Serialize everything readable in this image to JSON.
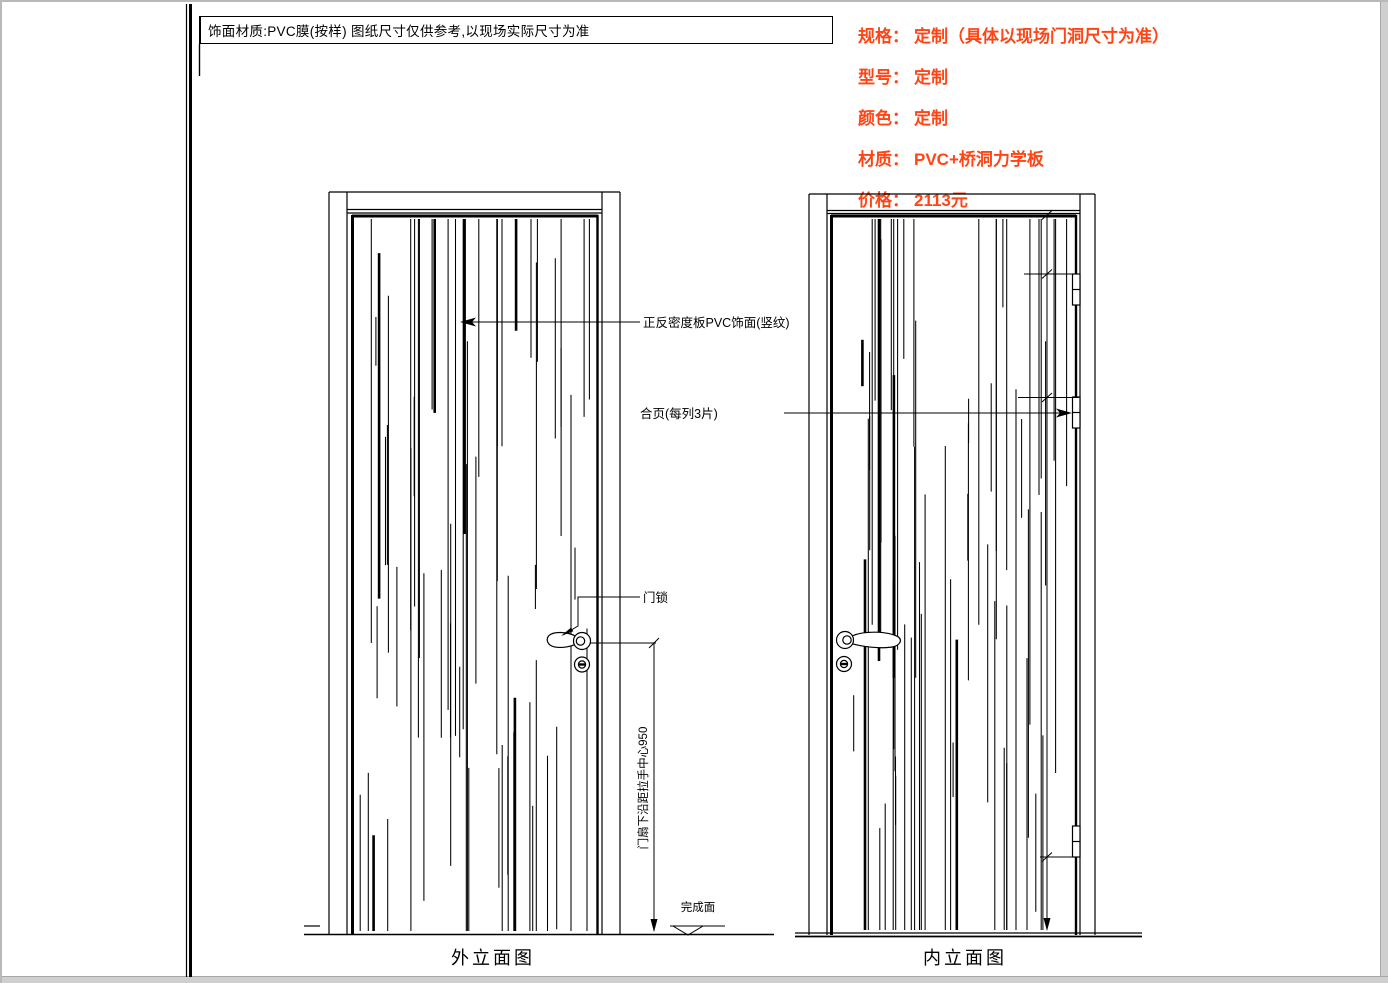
{
  "page": {
    "title_note": "饰面材质:PVC膜(按样) 图纸尺寸仅供参考,以现场实际尺寸为准"
  },
  "specs": {
    "color": "#ff4516",
    "items": [
      {
        "label": "规格：",
        "value": "定制（具体以现场门洞尺寸为准）"
      },
      {
        "label": "型号：",
        "value": "定制"
      },
      {
        "label": "颜色：",
        "value": "定制"
      },
      {
        "label": "材质：",
        "value": "PVC+桥洞力学板"
      },
      {
        "label": "价格：",
        "value": "2113元"
      }
    ]
  },
  "annotations": {
    "finish_label": "正反密度板PVC饰面(竖纹)",
    "hinge_label": "合页(每列3片)",
    "lock_label": "门锁",
    "handle_dim_label": "门扇下沿距拉手中心950",
    "finished_surface_label": "完成面"
  },
  "views": {
    "exterior_label": "外立面图",
    "interior_label": "内立面图"
  }
}
